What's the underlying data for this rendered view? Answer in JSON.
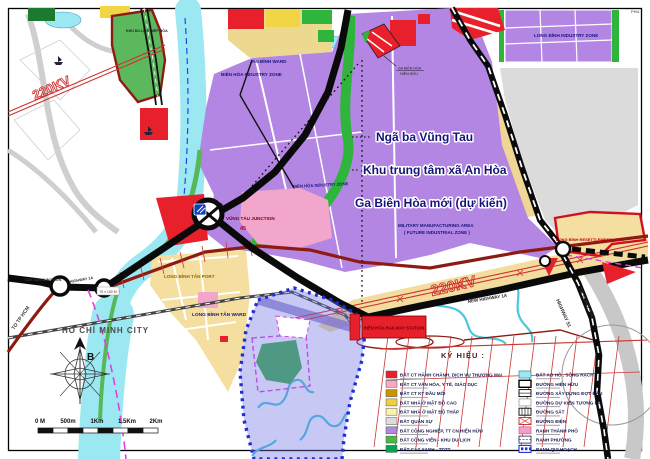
{
  "map": {
    "title_region": "Biên Hòa / Long Bình planning map",
    "callouts": {
      "line1": "Ngã ba Vũng Tau",
      "line2": "Khu trung tâm xã An Hòa",
      "line3": "Ga Biên Hòa mới (dự kiến)"
    },
    "labels": {
      "hcm_city": "HỒ CHÍ MINH CITY",
      "to_tp_hcm": "TO TP HCM",
      "tan_van_junction": "TÂN VẠN JUNCTION",
      "highway_1a": "HIGHWAY 1A",
      "block_size": "70 x 100 M",
      "lbt_port": "LONG BÌNH TÂN PORT",
      "lbt_ward": "LONG BÌNH TÂN WARD",
      "an_binh_ward": "AN BÌNH WARD",
      "bh_iz_1": "BIÊN HÒA INDUSTRY ZONE",
      "bh_iz_2": "BIÊN HÒA INDUSTRY ZONE",
      "lb_iz": "LONG BÌNH INDUSTRY ZONE",
      "military_1": "MILITARY MANUFACTURING AREA",
      "military_2": "( FUTURE INDUSTRIAL ZONE )",
      "lb_resettlement": "LONG BÌNH RESETTLEMENT AREA",
      "vt_junction": "VŨNG TÀU JUNCTION",
      "vt_junction_num": "45",
      "bh_rail_station": "BIÊN HÒA RAILWAY STATION",
      "new_hw_1a": "NEW HIGHWAY 1A",
      "to_vung_tau": "TO VŨNG TÀU",
      "highway_51": "HIGHWAY 51",
      "kv220_nw": "220KV",
      "kv220_se": "220KV",
      "hiep_hoa": "KHU DU LỊCH HIỆP HÒA",
      "ga_existing_1": "GA BIÊN HÒA",
      "ga_existing_2": "HIỆN HỮU",
      "phu": "PHU"
    },
    "compass": {
      "north": "B"
    },
    "scale_ticks": [
      "0 M",
      "500m",
      "1Km",
      "1.5Km",
      "2Km"
    ],
    "legend": {
      "title": "KÝ HIỆU :",
      "left": [
        {
          "label": "ĐẤT CT HÀNH CHÁNH, DỊCH VỤ THƯƠNG MẠI",
          "color": "#E8202C"
        },
        {
          "label": "ĐẤT CT VĂN HÓA, Y TẾ, GIÁO DỤC",
          "color": "#F7A8C4"
        },
        {
          "label": "ĐẤT CT KT ĐẦU MỐI",
          "color": "#CC9500"
        },
        {
          "label": "ĐẤT NHÀ Ở MẬT ĐỘ CAO",
          "color": "#F0D040"
        },
        {
          "label": "ĐẤT NHÀ Ở MẬT ĐỘ THẤP",
          "color": "#FAF2AE"
        },
        {
          "label": "ĐẤT QUÂN SỰ",
          "color": "#DCDCDC"
        },
        {
          "label": "ĐẤT CÔNG NGHIỆP, TT CN HIỆN HỮU",
          "color": "#B288DE"
        },
        {
          "label": "ĐẤT CÔNG VIÊN - KHU DU LỊCH",
          "color": "#4CB648"
        },
        {
          "label": "ĐẤT CÂY XANH - TDTT",
          "color": "#00A651"
        }
      ],
      "right": [
        {
          "label": "ĐẤT AO HỒ , SÔNG RẠCH"
        },
        {
          "label": "ĐƯỜNG HIỆN HỮU"
        },
        {
          "label": "ĐƯỜNG XÂY DỰNG ĐỢT ĐẦU"
        },
        {
          "label": "ĐƯỜNG DỰ KIẾN TƯƠNG LAI"
        },
        {
          "label": "ĐƯỜNG SẮT"
        },
        {
          "label": "ĐƯỜNG ĐIỆN"
        },
        {
          "label": "RANH THÀNH PHỐ"
        },
        {
          "label": "RANH PHƯỜNG"
        },
        {
          "label": "RANH QUI HOẠCH"
        }
      ]
    },
    "accent_colors": {
      "industry_purple": "#B486E4",
      "water_cyan": "#9CE8F2",
      "corridor_yellow": "#F3DD9E",
      "road_maroon": "#8E1B12",
      "boundary_blue": "#1F2FD4",
      "boundary_magenta": "#E040E0"
    }
  }
}
